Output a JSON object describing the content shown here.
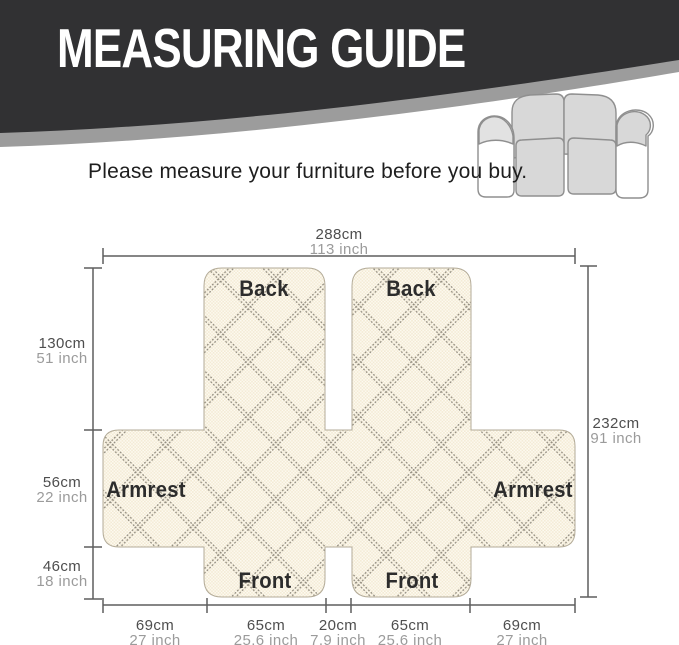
{
  "header": {
    "title": "MEASURING GUIDE",
    "subtitle": "Please measure your furniture before you buy."
  },
  "colors": {
    "banner": "#313133",
    "banner_swoosh": "#9c9c9c",
    "title_text": "#ffffff",
    "fabric_base": "#f3ead4",
    "fabric_lattice": "#8f897c",
    "dimension_line": "#5e5e5e",
    "cm_text": "#4e4e4e",
    "inch_text": "#9b9b9b",
    "panel_label_text": "#2c2c2c"
  },
  "diagram": {
    "panel_labels": {
      "back_left": "Back",
      "back_right": "Back",
      "front_left": "Front",
      "front_right": "Front",
      "armrest_left": "Armrest",
      "armrest_right": "Armrest"
    },
    "measurements": {
      "top_width": {
        "cm": "288cm",
        "inch": "113 inch"
      },
      "total_height": {
        "cm": "232cm",
        "inch": "91 inch"
      },
      "left": [
        {
          "cm": "130cm",
          "inch": "51 inch"
        },
        {
          "cm": "56cm",
          "inch": "22 inch"
        },
        {
          "cm": "46cm",
          "inch": "18 inch"
        }
      ],
      "bottom": [
        {
          "cm": "69cm",
          "inch": "27 inch"
        },
        {
          "cm": "65cm",
          "inch": "25.6 inch"
        },
        {
          "cm": "20cm",
          "inch": "7.9 inch"
        },
        {
          "cm": "65cm",
          "inch": "25.6 inch"
        },
        {
          "cm": "69cm",
          "inch": "27 inch"
        }
      ]
    }
  }
}
